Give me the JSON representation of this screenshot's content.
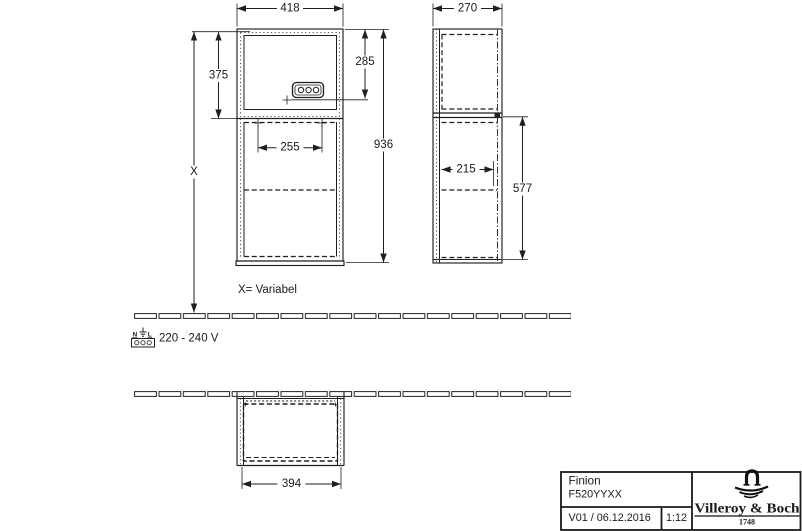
{
  "dims": {
    "front_width": "418",
    "front_upper_height": "375",
    "front_socket_height": "285",
    "front_total_height": "936",
    "front_inner_width": "255",
    "front_variable": "X",
    "side_depth": "270",
    "side_inner_depth": "215",
    "side_lower_height": "577",
    "plan_width": "394"
  },
  "annotations": {
    "variable_note": "X= Variabel",
    "voltage_note": "220 - 240 V",
    "terminal_n": "N",
    "terminal_l": "L"
  },
  "title_block": {
    "product": "Finion",
    "article_code": "F520YYXX",
    "version_date": "V01 / 06.12.2016",
    "scale": "1:12",
    "brand_name": "Villeroy & Boch",
    "brand_year": "1748"
  }
}
